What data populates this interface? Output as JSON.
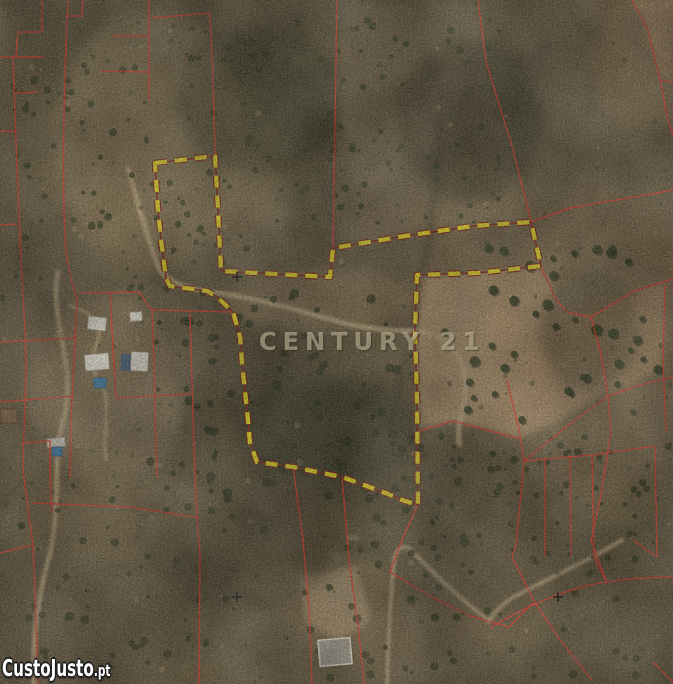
{
  "watermarks": {
    "center_brand": "CENTURY 21",
    "corner_brand": "CustoJusto",
    "corner_brand_suffix": ".pt"
  },
  "colors": {
    "highlight_boundary": "#f2e41f",
    "highlight_boundary_outline": "#7c1b10",
    "highlight_underlay": "#8a2012",
    "cadastral_line": "#ee3529",
    "center_watermark_color": "rgba(212,202,172,0.55)",
    "corner_watermark_fill": "#ffffff",
    "road_color": "#c3aa80",
    "pool_color": "#3f7fae",
    "roof_color": "#ece8dc"
  },
  "markers": {
    "survey_cross_count": "3",
    "survey_cross_color": "#101010"
  }
}
